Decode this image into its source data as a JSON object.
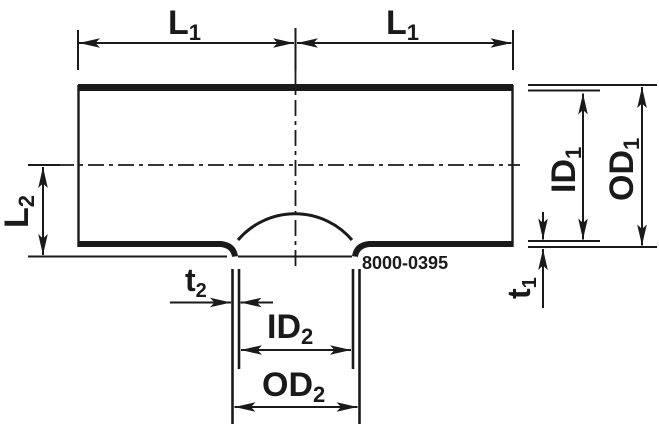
{
  "drawing": {
    "title": "tee-outlet-fitting-dimension-diagram",
    "part_number": "8000-0395",
    "dimensions": {
      "l1_left": {
        "main": "L",
        "sub": "1"
      },
      "l1_right": {
        "main": "L",
        "sub": "1"
      },
      "l2": {
        "main": "L",
        "sub": "2"
      },
      "id1": {
        "main": "ID",
        "sub": "1"
      },
      "od1": {
        "main": "OD",
        "sub": "1"
      },
      "t1": {
        "main": "t",
        "sub": "1"
      },
      "t2": {
        "main": "t",
        "sub": "2"
      },
      "id2": {
        "main": "ID",
        "sub": "2"
      },
      "od2": {
        "main": "OD",
        "sub": "2"
      }
    },
    "colors": {
      "ink": "#1a1a1a",
      "background": "#ffffff"
    }
  }
}
